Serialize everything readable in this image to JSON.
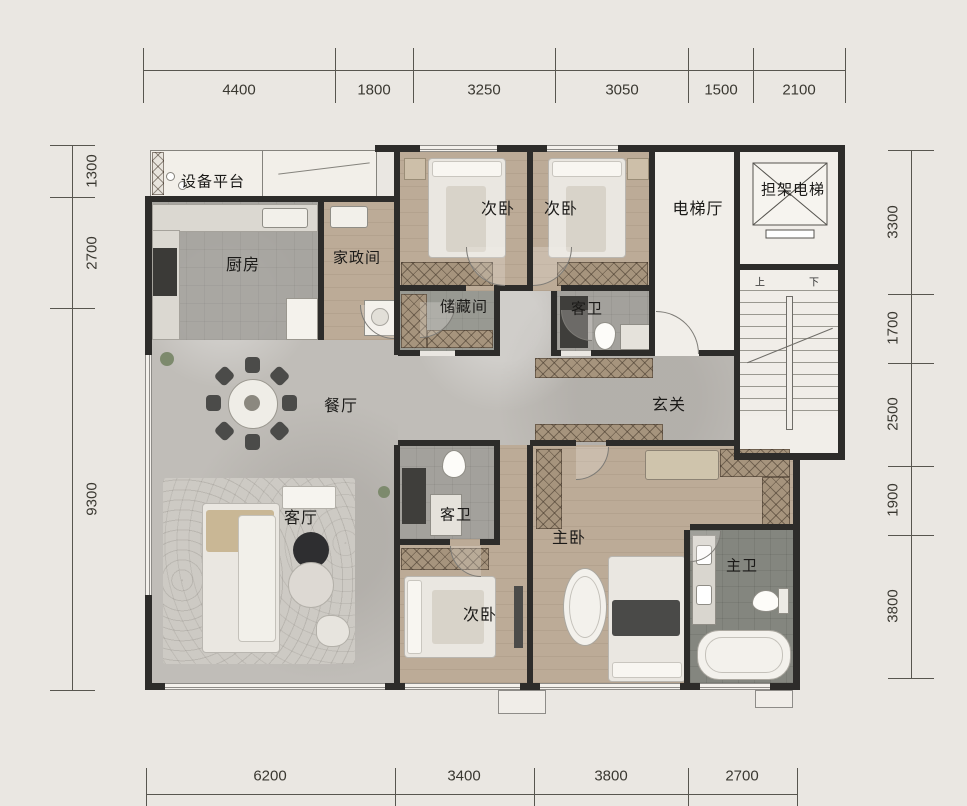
{
  "plan": {
    "rooms": [
      {
        "id": "equipment-platform",
        "label": "设备平台"
      },
      {
        "id": "kitchen",
        "label": "厨房"
      },
      {
        "id": "laundry",
        "label": "家政间"
      },
      {
        "id": "bedroom-top-left",
        "label": "次卧"
      },
      {
        "id": "bedroom-top-right",
        "label": "次卧"
      },
      {
        "id": "elevator-hall",
        "label": "电梯厅"
      },
      {
        "id": "stretcher-elevator",
        "label": "担架电梯"
      },
      {
        "id": "storage",
        "label": "储藏间"
      },
      {
        "id": "guest-bath-top",
        "label": "客卫"
      },
      {
        "id": "dining",
        "label": "餐厅"
      },
      {
        "id": "foyer",
        "label": "玄关"
      },
      {
        "id": "living",
        "label": "客厅"
      },
      {
        "id": "guest-bath-mid",
        "label": "客卫"
      },
      {
        "id": "bedroom-bottom",
        "label": "次卧"
      },
      {
        "id": "master-bedroom",
        "label": "主卧"
      },
      {
        "id": "master-bath",
        "label": "主卫"
      }
    ],
    "stairs": {
      "up": "上",
      "down": "下"
    },
    "dims": {
      "top": [
        "4400",
        "1800",
        "3250",
        "3050",
        "1500",
        "2100"
      ],
      "bottom": [
        "6200",
        "3400",
        "3800",
        "2700"
      ],
      "left": [
        "1300",
        "2700",
        "9300"
      ],
      "right": [
        "3300",
        "1700",
        "2500",
        "1900",
        "3800"
      ]
    },
    "colors": {
      "wall": "#2d2c2a",
      "wood": "#b7a794",
      "stone": "#c0bdb8",
      "tile": "#a3a19c",
      "background": "#eae7e2"
    }
  }
}
